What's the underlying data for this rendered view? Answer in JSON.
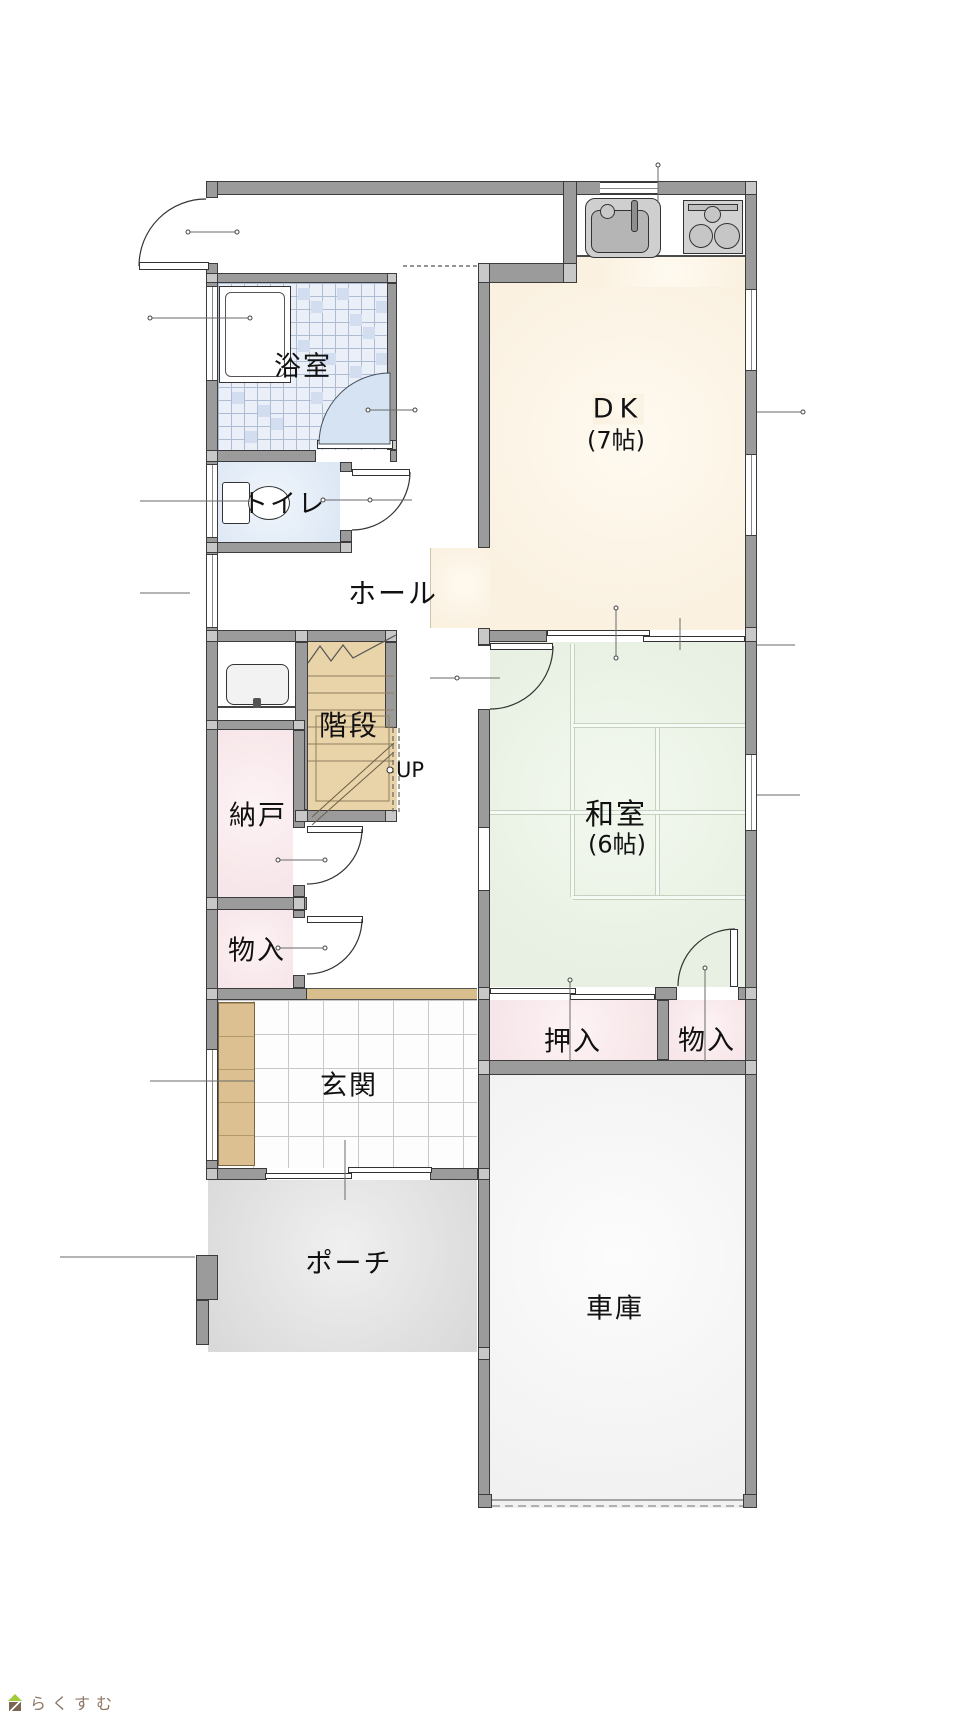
{
  "rooms": {
    "bathroom": {
      "label": "浴室"
    },
    "toilet": {
      "label": "トイレ"
    },
    "hall": {
      "label": "ホール"
    },
    "stairs": {
      "label": "階段",
      "direction": "UP"
    },
    "storage": {
      "label": "納戸"
    },
    "closet_left": {
      "label": "物入"
    },
    "entrance": {
      "label": "玄関"
    },
    "porch": {
      "label": "ポーチ"
    },
    "dining_kitchen": {
      "label": "DK",
      "size": "(7帖)"
    },
    "japanese_room": {
      "label": "和室",
      "size": "(6帖)"
    },
    "oshiire": {
      "label": "押入"
    },
    "closet_right": {
      "label": "物入"
    },
    "garage": {
      "label": "車庫"
    }
  },
  "branding": {
    "logo_text": "らくすむ"
  },
  "colors": {
    "wall_fill": "#9b9b9b",
    "wall_line": "#3c3c3c",
    "dk_floor": "#faf1e1",
    "tatami_floor": "#e7f0e2",
    "closet_floor": "#f7e6e9",
    "toilet_floor": "#dde8f5",
    "bath_tile": "#eaeff8",
    "stairs_floor": "#e9d3a9",
    "genkan_tan": "#dcc091",
    "porch_floor": "#d9d9d9",
    "garage_floor": "#f1f1f1",
    "bath_door": "#d6e3f2",
    "logo_brown": "#8d7664",
    "logo_green": "#a3c93c"
  }
}
